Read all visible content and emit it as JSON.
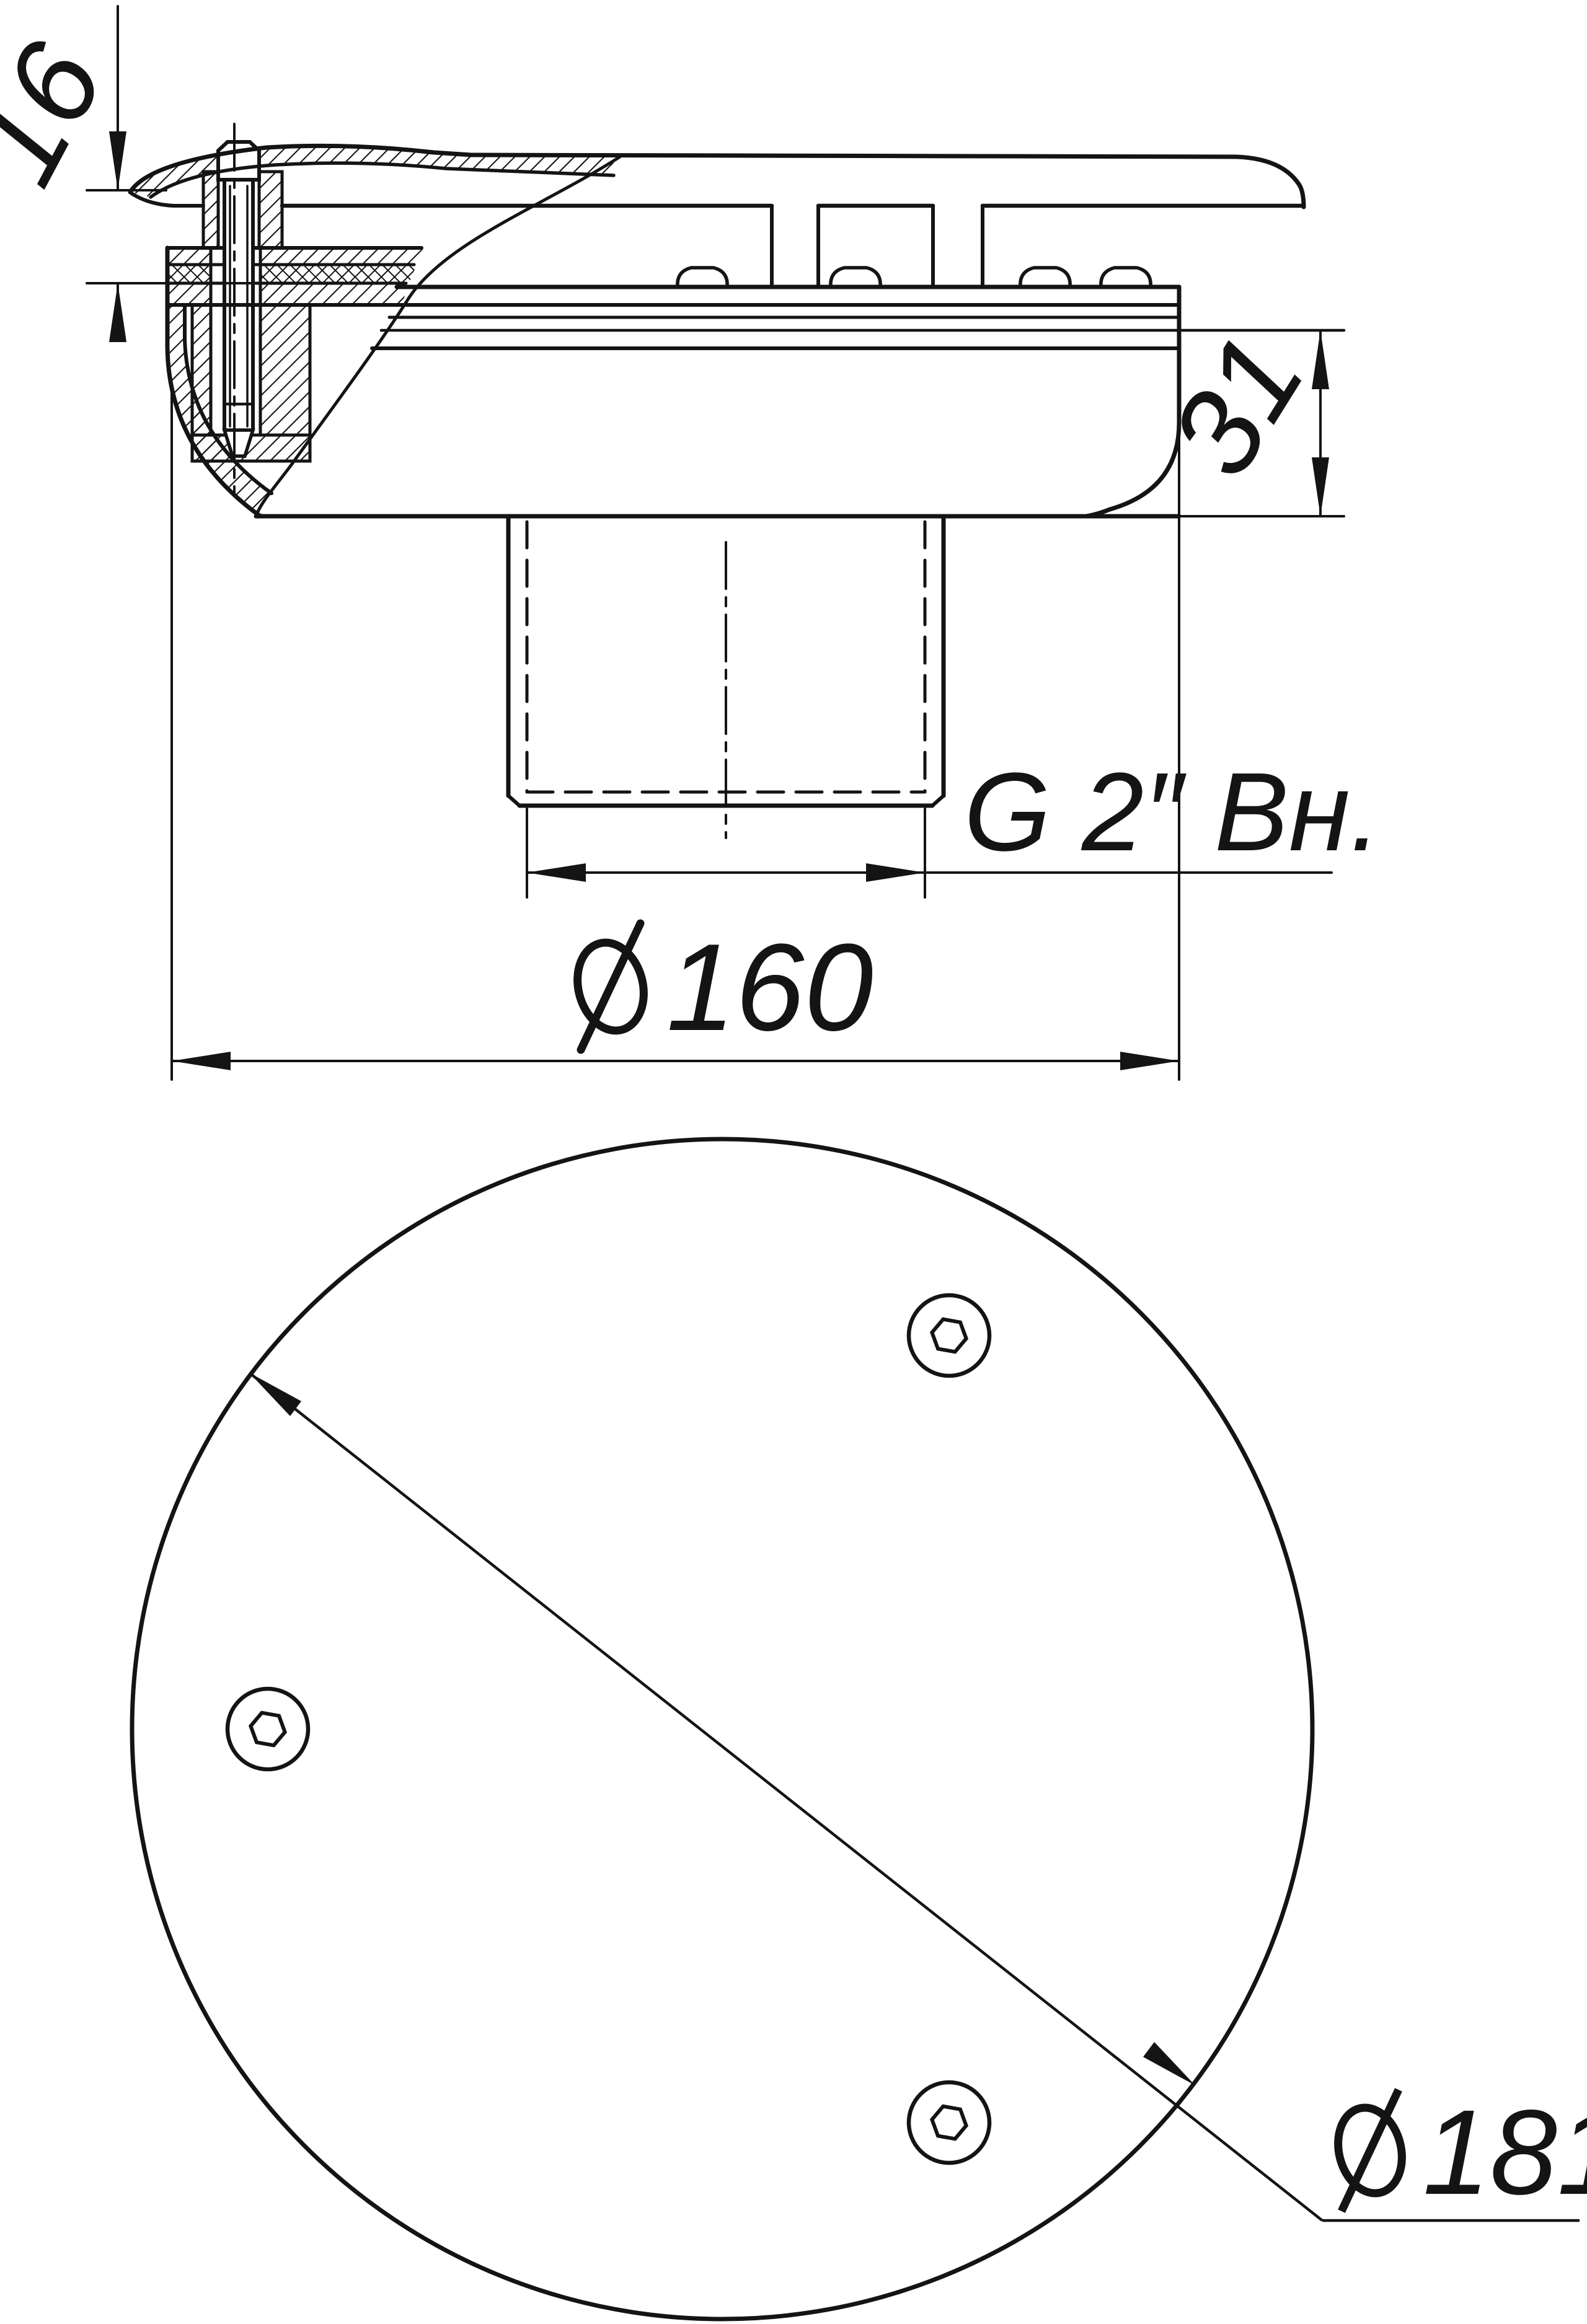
{
  "drawing": {
    "type": "technical-section-drawing",
    "background_color": "#ffffff",
    "line_color": "#141414",
    "views": [
      {
        "id": "section-view",
        "description": "partial cross-section of circular fitting with cover, gasket sandwich, fixing screw and threaded socket"
      },
      {
        "id": "bottom-view",
        "description": "bottom circular view with three hex-socket screws and diagonal diameter dimension"
      }
    ],
    "dimensions": {
      "thickness": "16",
      "height": "31",
      "thread": "G 2″ Вн.",
      "body_diameter": "160",
      "cover_diameter": "181"
    },
    "symbols": {
      "diameter": "⌀"
    },
    "screw_count": 3
  }
}
